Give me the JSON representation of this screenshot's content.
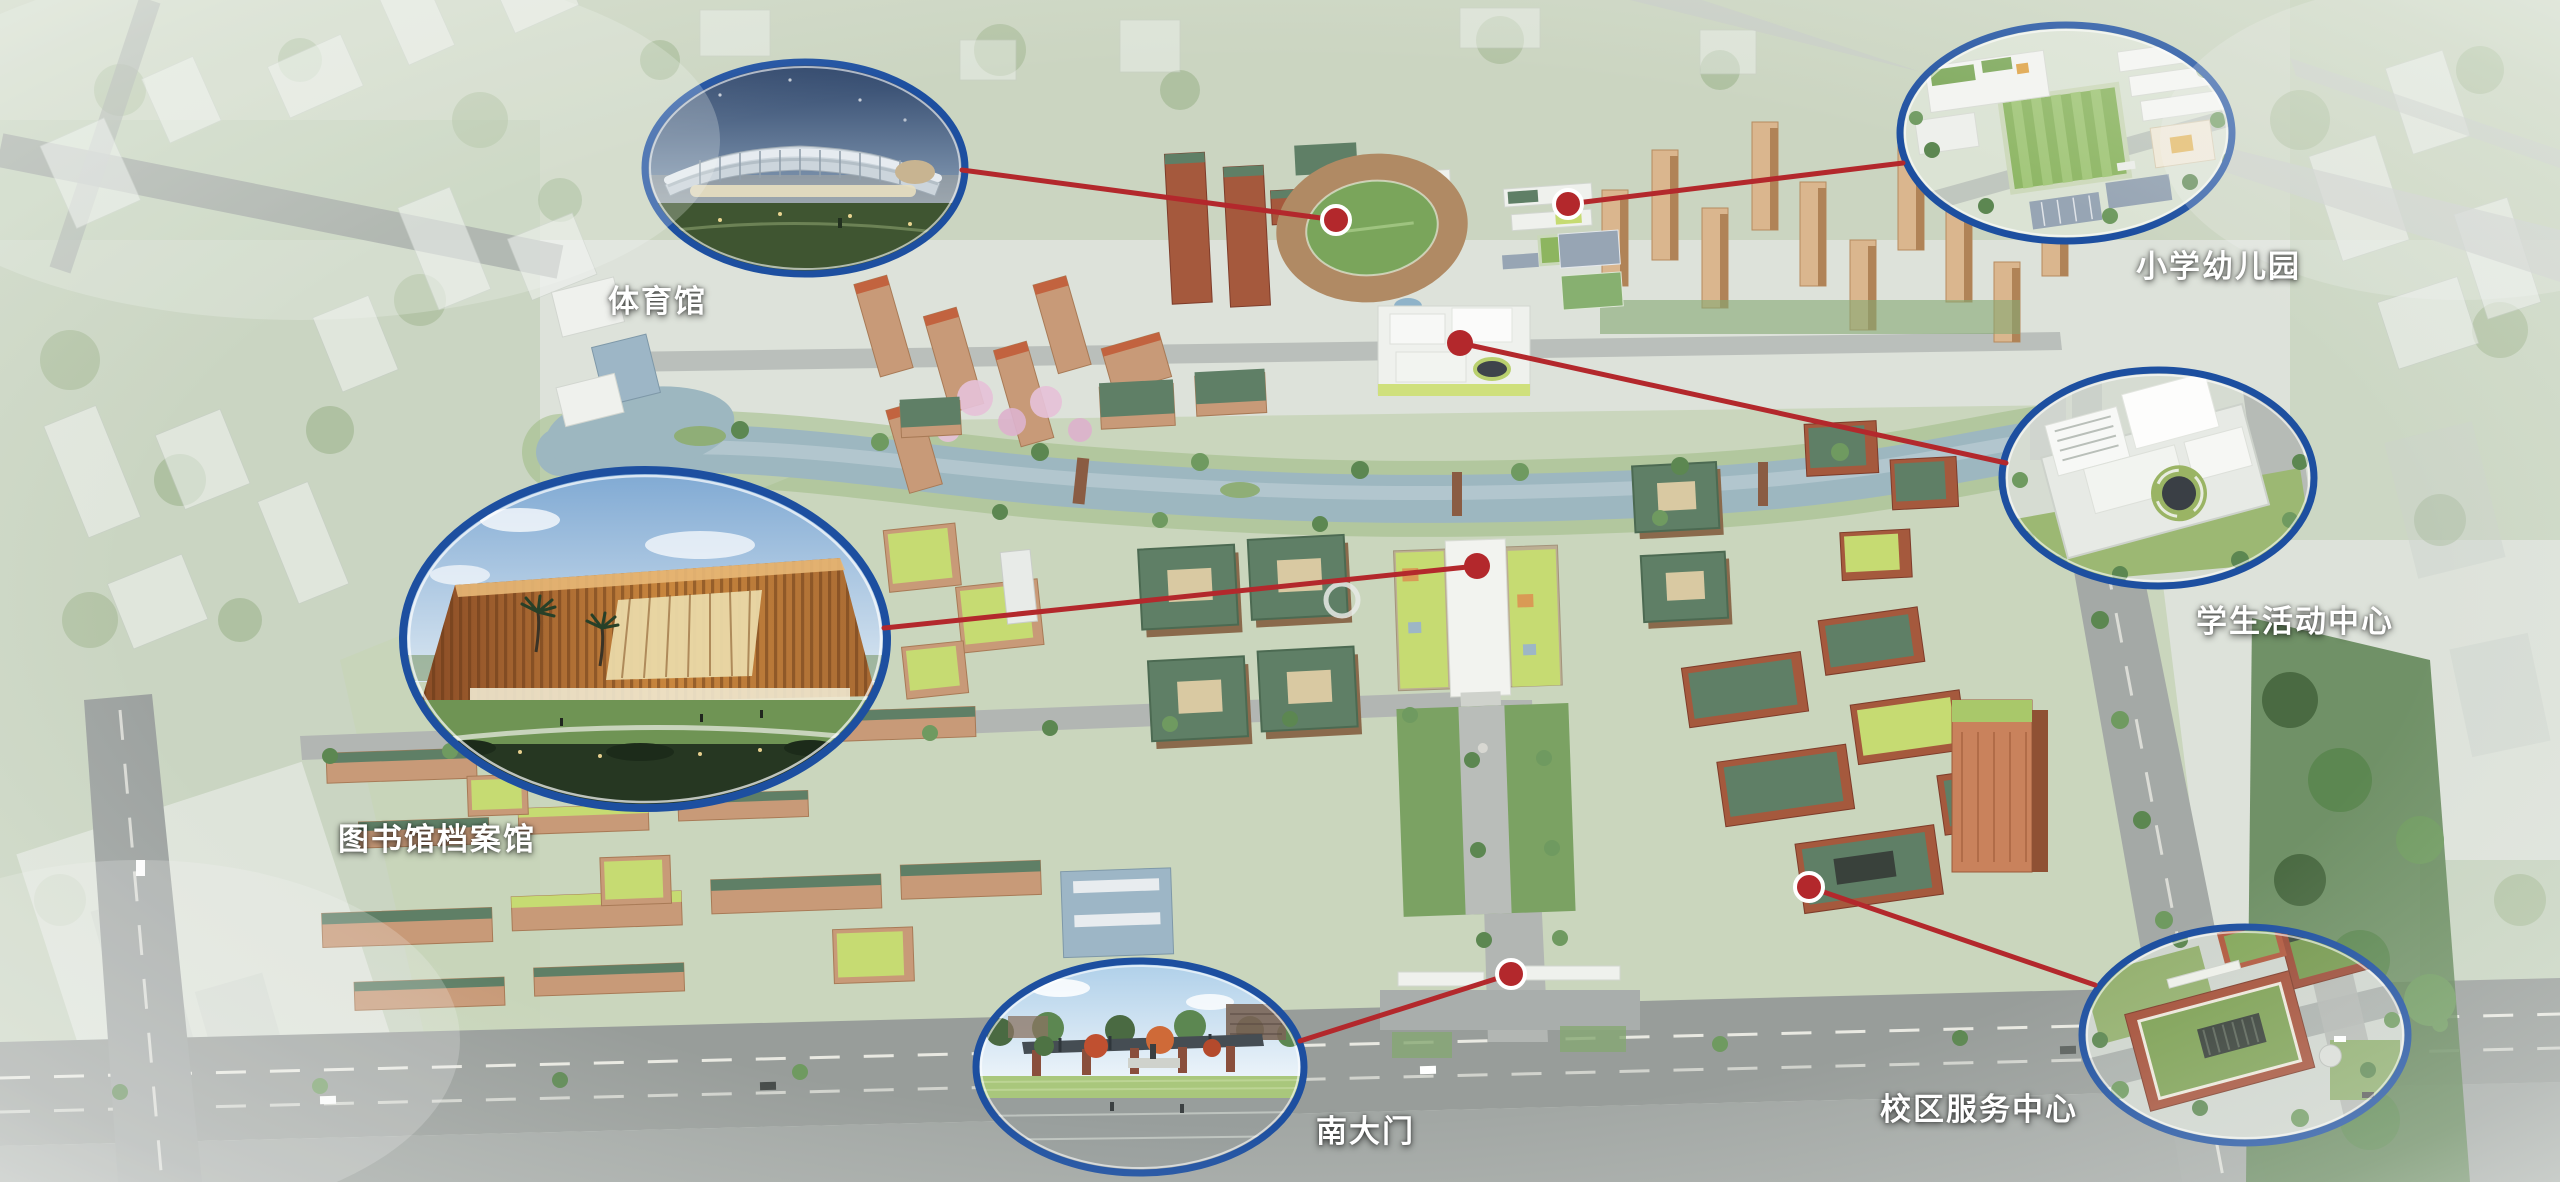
{
  "colors": {
    "callout_border": "#1d4fa0",
    "callout_inner_rim": "#ffffff",
    "connector_red": "#b3282c",
    "marker_red": "#b3282c",
    "marker_ring": "#ffffff",
    "label_text": "#ffffff",
    "water": "#9db7c0",
    "grass": "#86a873",
    "green_roof": "#5f7f66",
    "lime_roof": "#c6db72",
    "terracotta": "#c0714b",
    "road": "#9a9f9c"
  },
  "callouts": [
    {
      "id": "gymnasium",
      "label": "体育馆",
      "ellipse": {
        "cx": 805,
        "cy": 168,
        "rx": 160,
        "ry": 106
      },
      "label_pos": {
        "x": 608,
        "y": 276
      },
      "marker": {
        "x": 1336,
        "y": 220,
        "ring": true
      },
      "line": {
        "x1": 962,
        "y1": 170,
        "x2": 1336,
        "y2": 220
      }
    },
    {
      "id": "primary-school-kindergarten",
      "label": "小学幼儿园",
      "ellipse": {
        "cx": 2066,
        "cy": 133,
        "rx": 166,
        "ry": 108
      },
      "label_pos": {
        "x": 2136,
        "y": 241
      },
      "marker": {
        "x": 1568,
        "y": 204,
        "ring": true
      },
      "line": {
        "x1": 1903,
        "y1": 163,
        "x2": 1568,
        "y2": 204
      }
    },
    {
      "id": "student-activity-center",
      "label": "学生活动中心",
      "ellipse": {
        "cx": 2158,
        "cy": 478,
        "rx": 156,
        "ry": 108
      },
      "label_pos": {
        "x": 2196,
        "y": 596
      },
      "marker": {
        "x": 1460,
        "y": 343,
        "ring": false
      },
      "line": {
        "x1": 2006,
        "y1": 463,
        "x2": 1460,
        "y2": 343
      }
    },
    {
      "id": "library-archives",
      "label": "图书馆档案馆",
      "ellipse": {
        "cx": 645,
        "cy": 639,
        "rx": 242,
        "ry": 169
      },
      "label_pos": {
        "x": 338,
        "y": 814
      },
      "marker": {
        "x": 1477,
        "y": 566,
        "ring": false
      },
      "line": {
        "x1": 884,
        "y1": 628,
        "x2": 1477,
        "y2": 566
      }
    },
    {
      "id": "south-gate",
      "label": "南大门",
      "ellipse": {
        "cx": 1140,
        "cy": 1067,
        "rx": 164,
        "ry": 106
      },
      "label_pos": {
        "x": 1316,
        "y": 1106
      },
      "marker": {
        "x": 1511,
        "y": 974,
        "ring": true
      },
      "line": {
        "x1": 1300,
        "y1": 1041,
        "x2": 1511,
        "y2": 974
      }
    },
    {
      "id": "campus-service-center",
      "label": "校区服务中心",
      "ellipse": {
        "cx": 2245,
        "cy": 1035,
        "rx": 163,
        "ry": 108
      },
      "label_pos": {
        "x": 1880,
        "y": 1084
      },
      "marker": {
        "x": 1809,
        "y": 887,
        "ring": true
      },
      "line": {
        "x1": 2095,
        "y1": 985,
        "x2": 1809,
        "y2": 887
      }
    }
  ]
}
